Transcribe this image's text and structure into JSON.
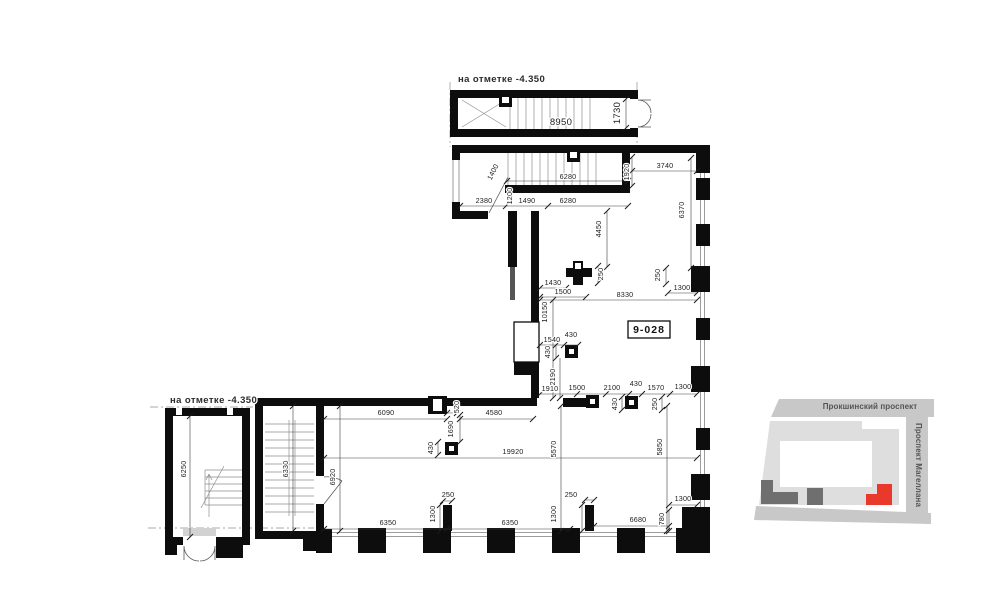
{
  "plan": {
    "elevation_label_top": "на отметке -4.350",
    "elevation_label_left": "на отметке -4.350",
    "room_tag": "9-028",
    "dimensions": {
      "top_stair_block": [
        "8950",
        "1730"
      ],
      "upper_wing": [
        "2380",
        "1400",
        "1200",
        "1490",
        "6280",
        "6280",
        "1920",
        "3740",
        "6370",
        "4450"
      ],
      "mid_section": [
        "1430",
        "1500",
        "250",
        "8330",
        "250",
        "1300",
        "10150",
        "1540",
        "430",
        "430",
        "2190"
      ],
      "row_mid": [
        "1910",
        "1500",
        "2100",
        "430",
        "1570",
        "1300",
        "430",
        "250"
      ],
      "lower_wing": [
        "6090",
        "520",
        "4580",
        "1690",
        "430",
        "19920",
        "6920",
        "5570",
        "5850",
        "6250",
        "6330"
      ],
      "bottom_row": [
        "250",
        "1300",
        "6350",
        "6350",
        "250",
        "1300",
        "6680",
        "780",
        "1300"
      ]
    }
  },
  "minimap": {
    "street_top": "Прокшинский проспект",
    "street_right": "Проспект Магеллана",
    "highlight_color": "#e8392c"
  },
  "colors": {
    "wall": "#0d0d0d",
    "dim_text": "#1c1c1c",
    "street_gray": "#c8c8c8",
    "building_gray": "#dedede",
    "building_dark": "#6f6f6f"
  }
}
